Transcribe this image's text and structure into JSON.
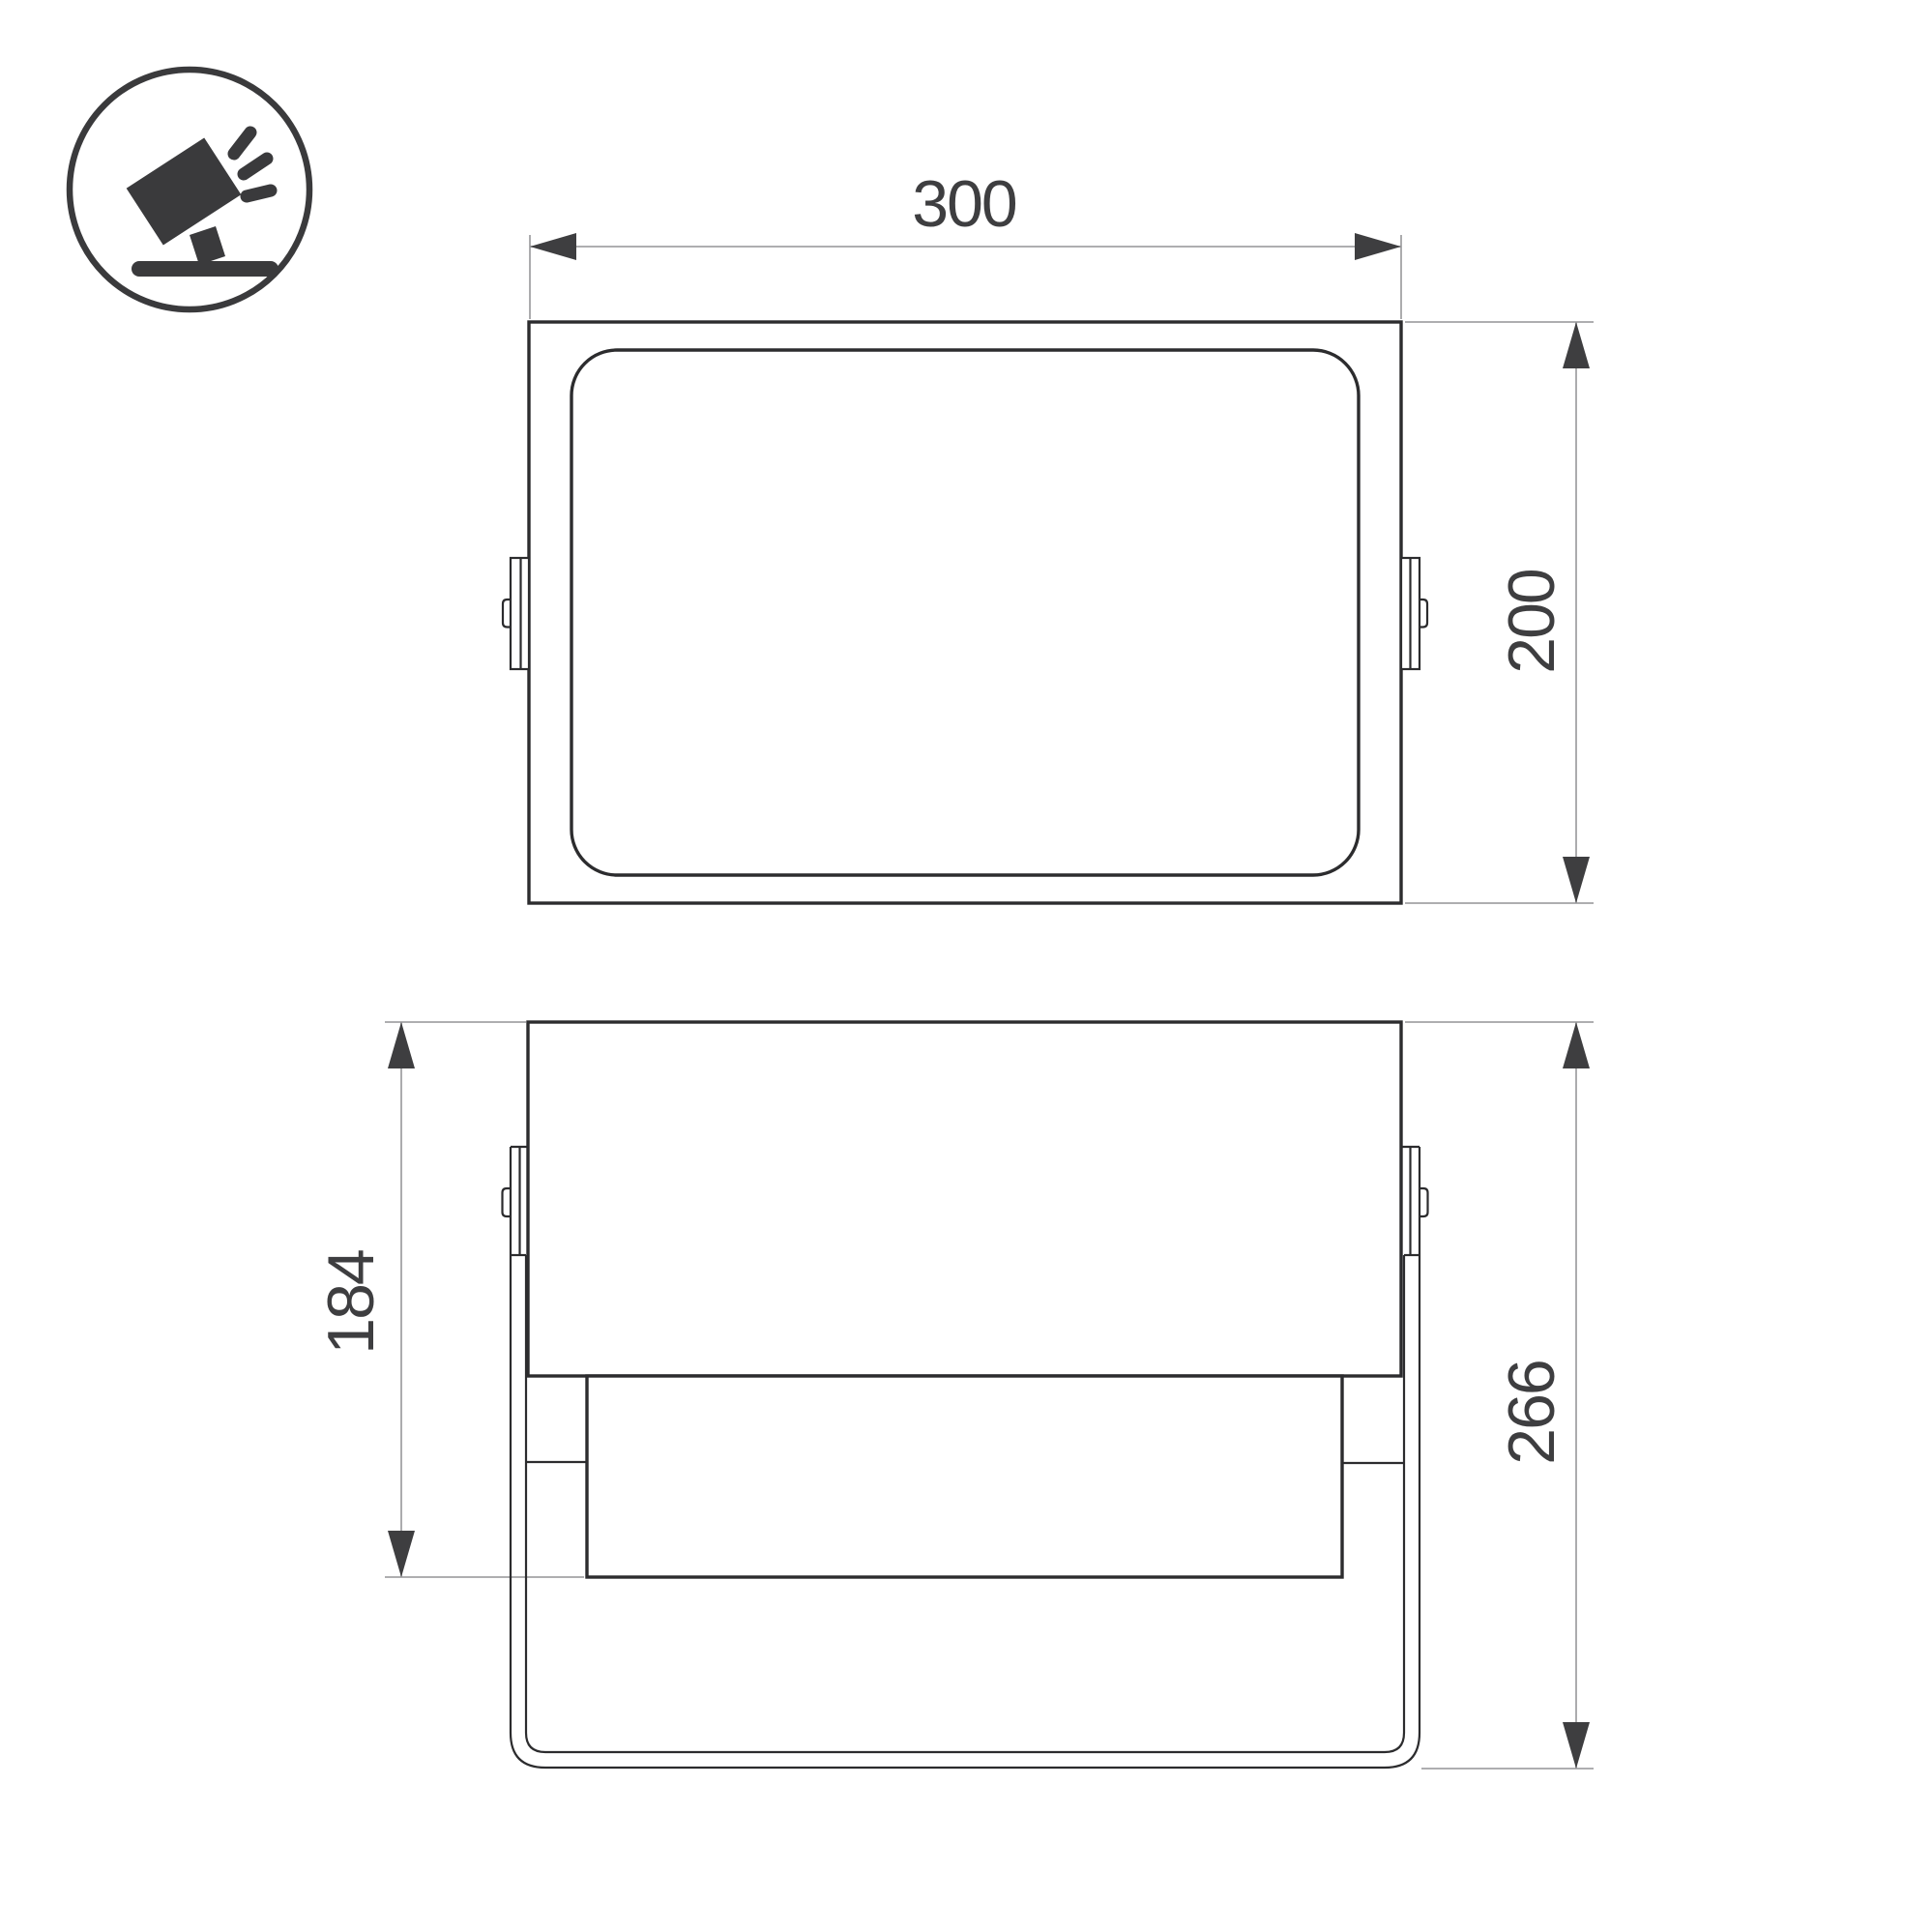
{
  "page": {
    "background": "#ffffff",
    "type": "technical-dimension-drawing"
  },
  "icon": {
    "name": "tilted-floodlight-on-stand",
    "color": "#3a3a3c"
  },
  "dimensions": {
    "front_width": "300",
    "front_height": "200",
    "side_body_height": "184",
    "side_total_height": "266"
  },
  "colors": {
    "outline": "#2c2c2e",
    "dimension": "#3e3e40",
    "extension": "#a3a3a5",
    "icon": "#3a3a3c"
  }
}
